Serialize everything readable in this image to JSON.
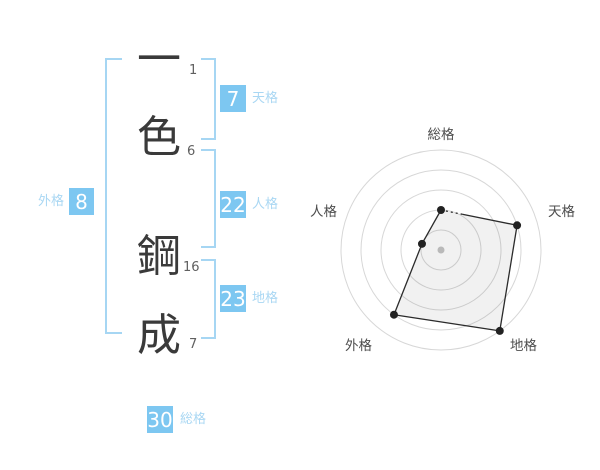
{
  "name": {
    "characters": [
      {
        "char": "一",
        "strokes": "1"
      },
      {
        "char": "色",
        "strokes": "6"
      },
      {
        "char": "鋼",
        "strokes": "16"
      },
      {
        "char": "成",
        "strokes": "7"
      }
    ]
  },
  "categories": {
    "tenkaku": {
      "value": "7",
      "label": "天格"
    },
    "jinkaku": {
      "value": "22",
      "label": "人格"
    },
    "chikaku": {
      "value": "23",
      "label": "地格"
    },
    "gaikaku": {
      "value": "8",
      "label": "外格"
    },
    "soukaku": {
      "value": "30",
      "label": "総格"
    }
  },
  "colors": {
    "badge_bg": "#7dc7f1",
    "badge_text": "#ffffff",
    "bracket": "#a6d6f3",
    "category_label": "#a9d7f3",
    "kanji_text": "#3a3a3a",
    "stroke_text": "#606060",
    "ring": "#d7d7d7",
    "axis_label": "#4d4d4d",
    "polygon_line": "#2b2b2b",
    "polygon_fill": "rgba(0,0,0,0.055)",
    "vertex_dot": "#222222",
    "center_dot": "#c4c4c4"
  },
  "chart_data": {
    "type": "radar",
    "axes": [
      "総格",
      "天格",
      "地格",
      "外格",
      "人格"
    ],
    "values": [
      2,
      4,
      5,
      4,
      1
    ],
    "max": 5,
    "rings": 5,
    "grid": "circular-rings",
    "legend": "none",
    "title": ""
  }
}
